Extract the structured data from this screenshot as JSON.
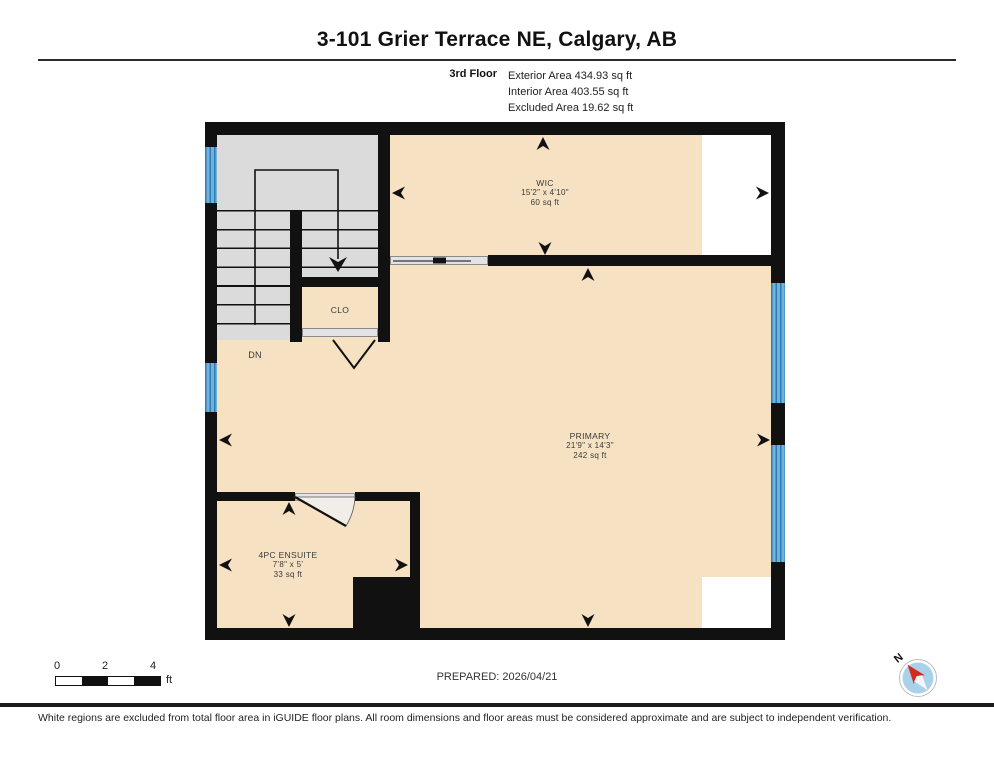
{
  "header": {
    "title": "3-101 Grier Terrace NE, Calgary, AB",
    "floor_label": "3rd Floor",
    "area_lines": [
      "Exterior Area 434.93 sq ft",
      "Interior Area 403.55 sq ft",
      "Excluded Area 19.62 sq ft"
    ]
  },
  "plan": {
    "rooms": {
      "wic": {
        "name": "WIC",
        "dims": "15'2\" x 4'10\"",
        "area": "60 sq ft"
      },
      "primary": {
        "name": "PRIMARY",
        "dims": "21'9\" x 14'3\"",
        "area": "242 sq ft"
      },
      "ensuite": {
        "name": "4PC ENSUITE",
        "dims": "7'8\" x 5'",
        "area": "33 sq ft"
      },
      "closet": {
        "name": "CLO"
      }
    },
    "stairs": {
      "direction_label": "DN"
    },
    "colors": {
      "room_fill": "#F6E1C3",
      "stair_fill": "#DBDBDB",
      "window_blue": "#4E9FD4",
      "wall_black": "#111111",
      "excluded_white": "#FFFFFF"
    }
  },
  "footer": {
    "scale": {
      "ticks": [
        "0",
        "2",
        "4"
      ],
      "unit": "ft"
    },
    "prepared": "PREPARED: 2026/04/21",
    "compass_label": "N",
    "compass_colors": {
      "needle_red": "#D42A1E",
      "dial_blue": "#A9D2EA"
    },
    "disclaimer": "White regions are excluded from total floor area in iGUIDE floor plans. All room dimensions and floor areas must be considered approximate and are subject to independent verification."
  }
}
